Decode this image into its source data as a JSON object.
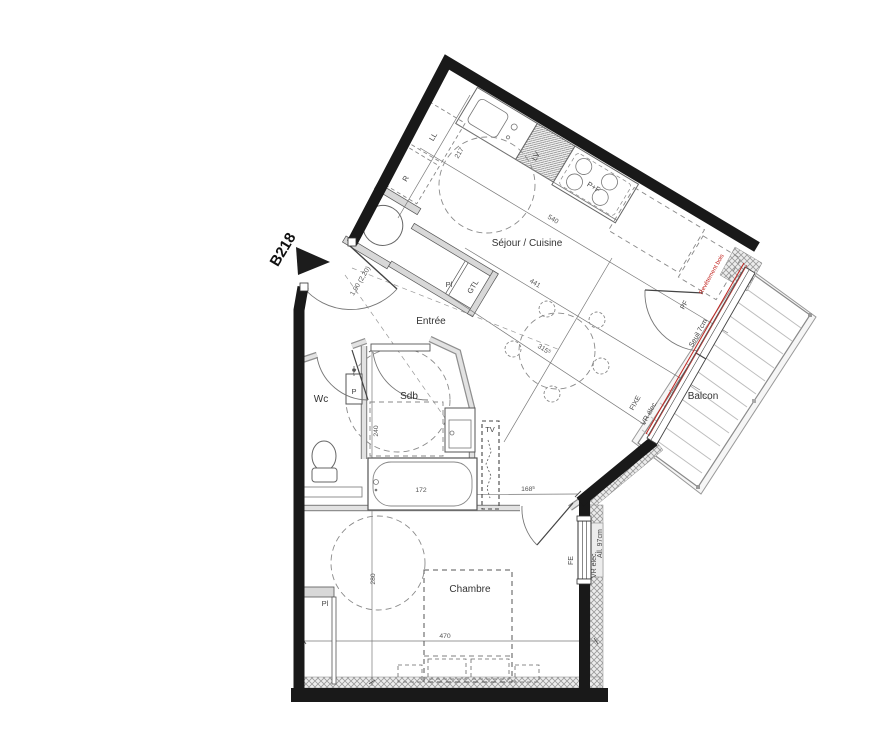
{
  "unit": {
    "label": "B218"
  },
  "rooms": {
    "sejour": "Séjour / Cuisine",
    "entree": "Entrée",
    "wc": "Wc",
    "sdb": "Sdb",
    "chambre": "Chambre",
    "balcon": "Balcon"
  },
  "appliances": {
    "lave_linge": "LL",
    "lave_vaisselle": "LV",
    "plaque_four": "P+F",
    "refrigerateur": "R",
    "tv": "TV",
    "p_unit": "P"
  },
  "storage": {
    "placard_entree": "Pl",
    "gtl": "GTL",
    "placard_chambre": "Pl"
  },
  "openings": {
    "porte_fenetre": "PF",
    "fixe": "FIXE",
    "fenetre": "FE",
    "vr_elec_sejour": "VR élec.",
    "vr_elec_chambre": "VR élec.",
    "allege": "All. 97cm",
    "seuil": "Seuil 7cm",
    "entry_door_dim": "1,90 (2,20)"
  },
  "annotations": {
    "red_note": "Revêtement bois"
  },
  "dimensions": {
    "d217": "217",
    "d540": "540",
    "d441": "441",
    "d315": {
      "v": "315",
      "s": "5"
    },
    "d240": "240",
    "d172": "172",
    "d168": {
      "v": "168",
      "s": "5"
    },
    "d280": "280",
    "d470": "470"
  },
  "colors": {
    "wall": "#191919",
    "partition": "#d8d8d8",
    "accent_red": "#c2241f",
    "line": "#555555"
  }
}
